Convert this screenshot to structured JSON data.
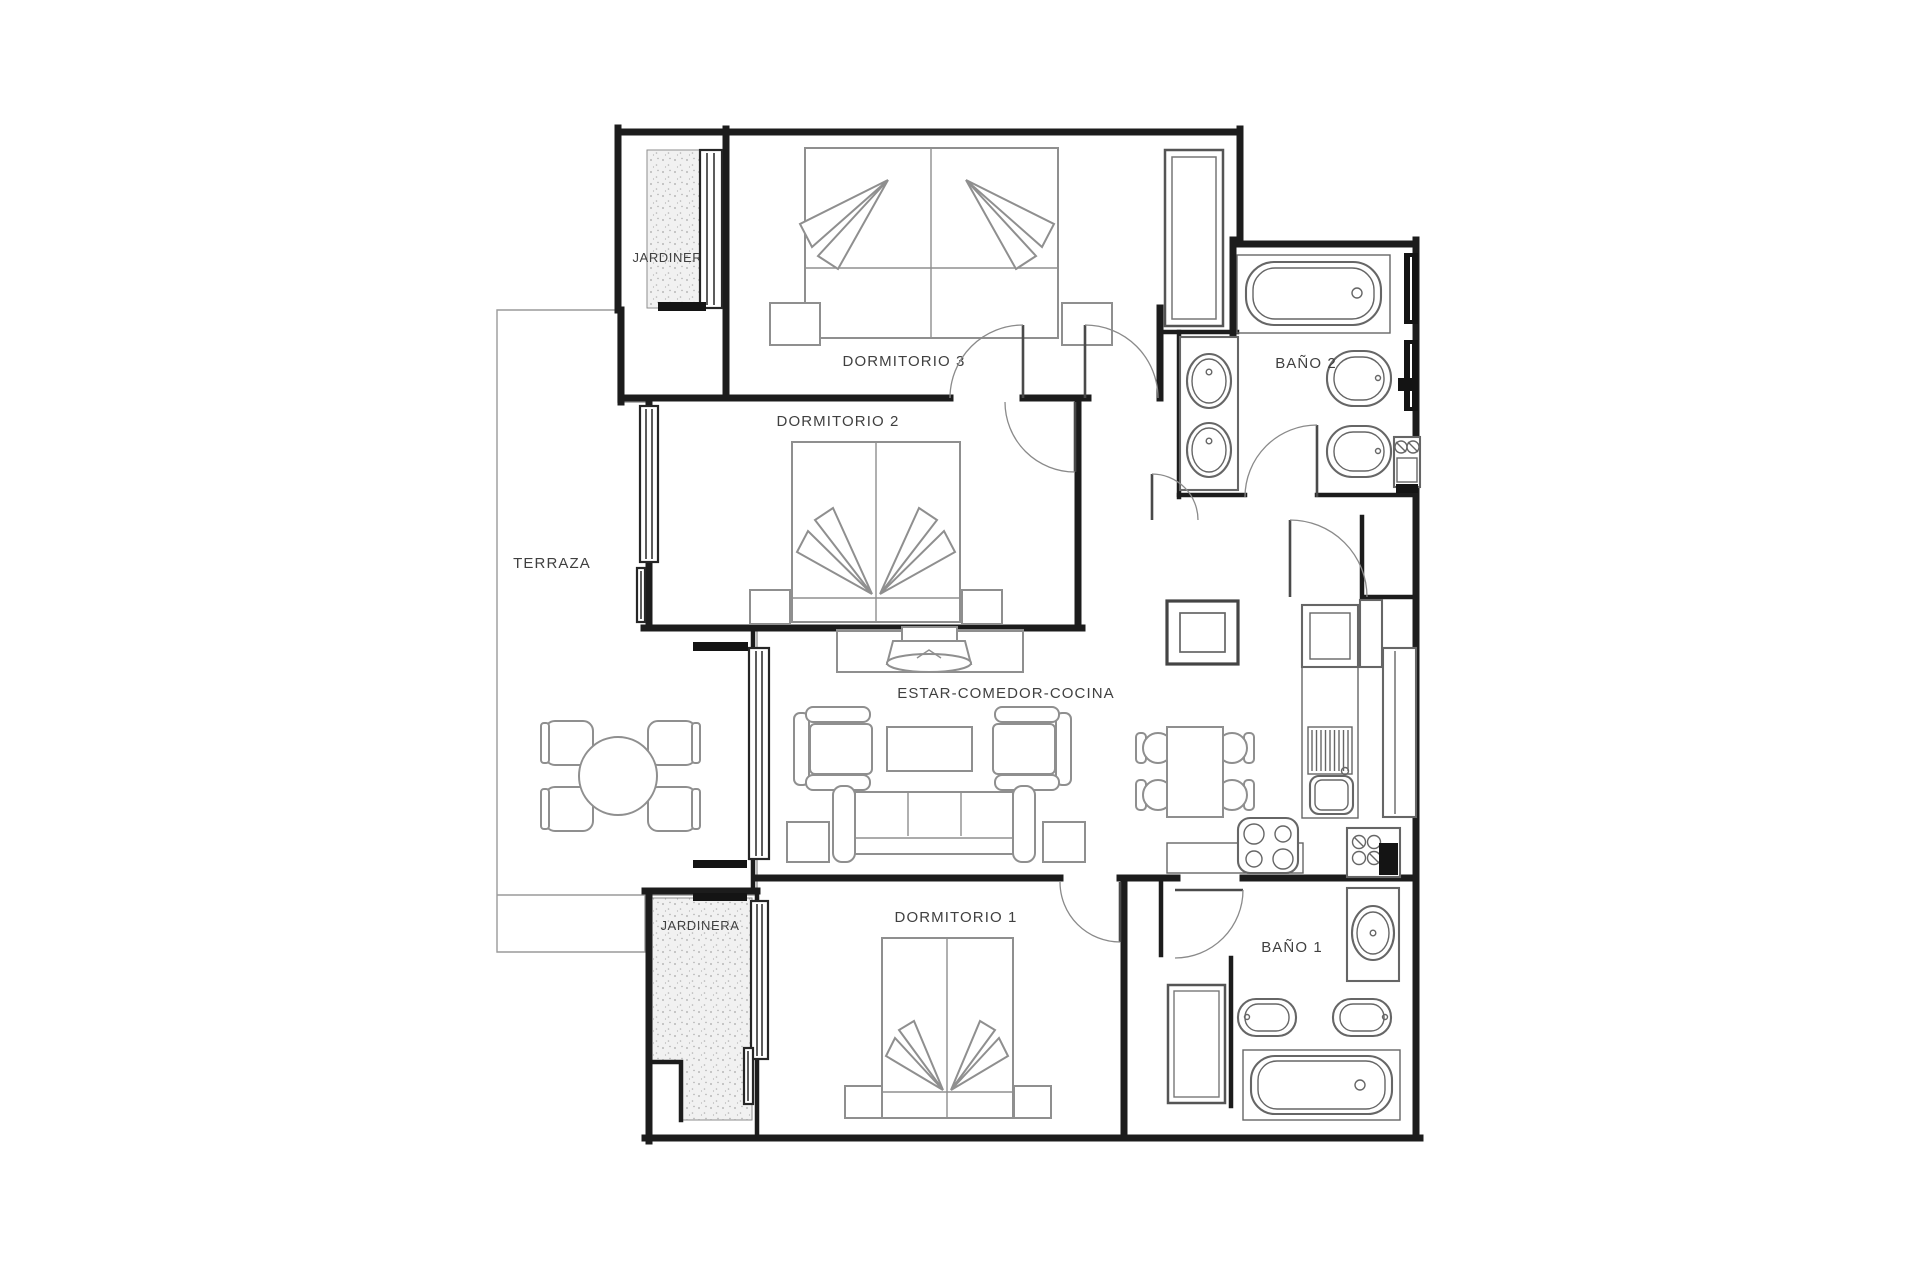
{
  "plan": {
    "labels": {
      "jardinera_top": "JARDINERA",
      "dormitorio3": "DORMITORIO 3",
      "bano2": "BAÑO 2",
      "dormitorio2": "DORMITORIO 2",
      "terraza": "TERRAZA",
      "estar_comedor_cocina": "ESTAR-COMEDOR-COCINA",
      "dormitorio1": "DORMITORIO 1",
      "bano1": "BAÑO 1",
      "jardinera_bottom": "JARDINERA"
    },
    "colors": {
      "wall": "#1c1c1c",
      "furniture": "#8f8f8f",
      "fixture": "#666666",
      "text": "#404040",
      "sill": "#141414",
      "paper": "#ffffff"
    }
  }
}
